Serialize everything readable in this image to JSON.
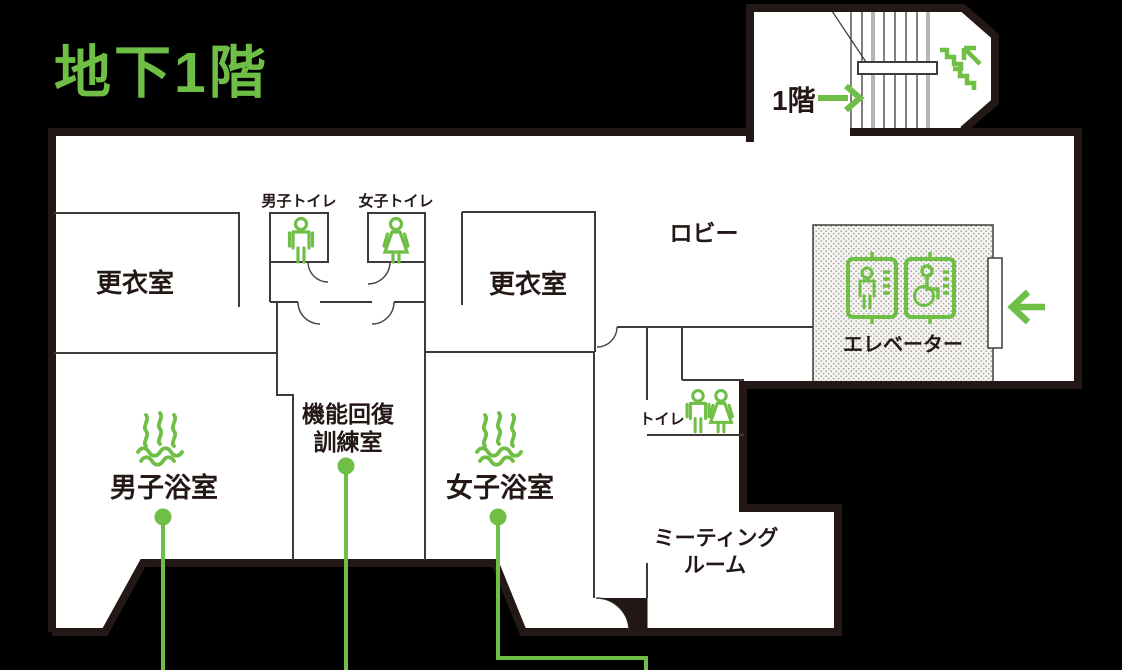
{
  "title": "地下1階",
  "colors": {
    "accent_green": "#6fbe45",
    "wall_dark": "#231815",
    "wall_thin": "#3e3a39",
    "floor_white": "#ffffff",
    "background": "#000000",
    "stair_gray": "#b5b5b6",
    "elevator_dot_gray": "#a9a7a4"
  },
  "stairwell": {
    "floor_label": "1階",
    "direction_icon": "stairs-up-icon",
    "arrow_icon": "arrow-right-icon"
  },
  "rooms": {
    "locker_left": {
      "label": "更衣室"
    },
    "locker_right": {
      "label": "更衣室"
    },
    "mens_toilet": {
      "label": "男子トイレ",
      "icon": "man-icon"
    },
    "womens_toilet": {
      "label": "女子トイレ",
      "icon": "woman-icon"
    },
    "lobby": {
      "label": "ロビー"
    },
    "elevator": {
      "label": "エレベーター",
      "icons": [
        "elevator-person-icon",
        "elevator-wheelchair-icon"
      ],
      "entrance_icon": "arrow-left-icon"
    },
    "training": {
      "label_line1": "機能回復",
      "label_line2": "訓練室"
    },
    "mens_bath": {
      "label": "男子浴室",
      "icon": "hot-spring-steam-icon"
    },
    "womens_bath": {
      "label": "女子浴室",
      "icon": "hot-spring-steam-icon"
    },
    "toilet": {
      "label": "トイレ",
      "icons": [
        "man-icon",
        "woman-icon"
      ]
    },
    "meeting_room": {
      "label_line1": "ミーティング",
      "label_line2": "ルーム"
    }
  }
}
